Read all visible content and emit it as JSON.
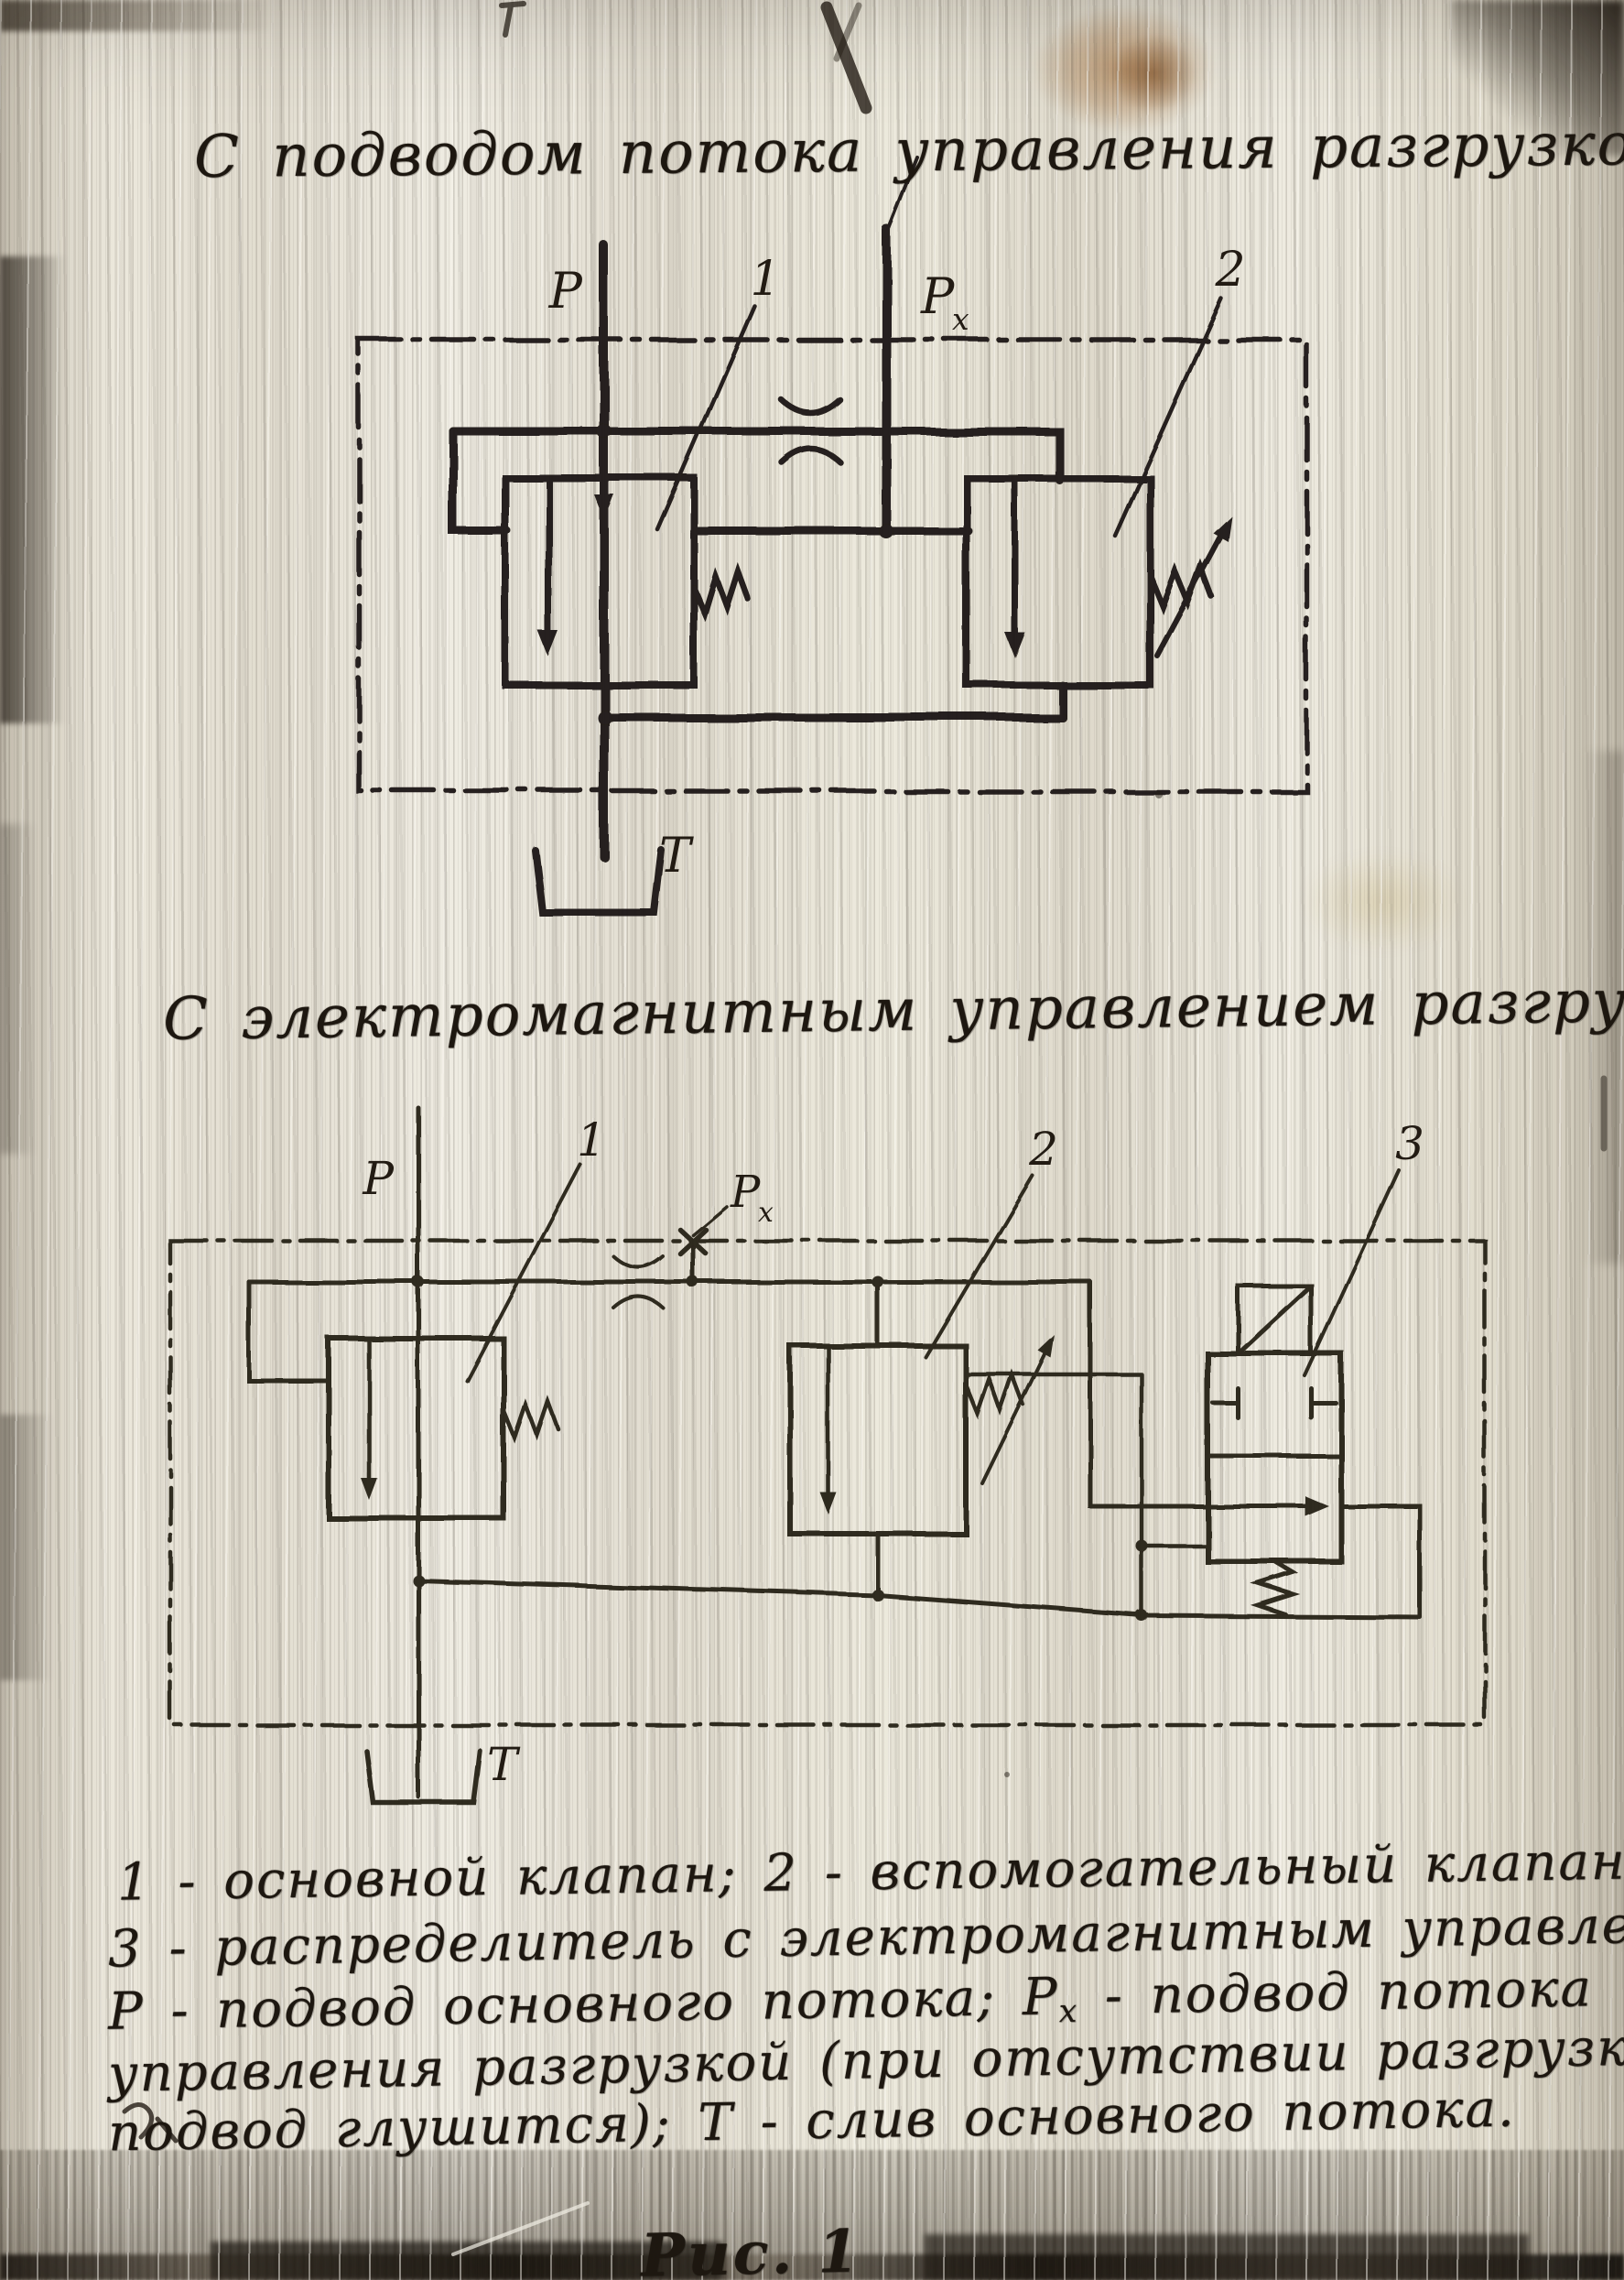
{
  "page": {
    "title_top": "С подводом потока управления разгрузкой",
    "title_middle": "С электромагнитным управлением разгрузкой",
    "figure_label": "Рис. 1",
    "caption": {
      "line1": "1 - основной клапан;  2 - вспомогательный клапан;",
      "line2": "3 - распределитель с электромагнитным управлением;",
      "line3_pre": "Р - подвод основного потока; Р",
      "line3_sub": "х",
      "line3_post": " - подвод потока",
      "line4": "управления разгрузкой (при отсутствии разгрузки",
      "line5": "подвод глушится); Т - слив основного потока."
    },
    "ink_color": "#221b13",
    "paper_color": "#e7e2d5"
  },
  "diagram1": {
    "name": "unloading by pilot flow supply",
    "labels": {
      "p": "Р",
      "px_base": "Р",
      "px_sub": "х",
      "t": "Т",
      "n1": "1",
      "n2": "2"
    }
  },
  "diagram2": {
    "name": "unloading by electromagnetic control",
    "labels": {
      "p": "Р",
      "px_base": "Р",
      "px_sub": "х",
      "t": "Т",
      "n1": "1",
      "n2": "2",
      "n3": "3"
    }
  }
}
